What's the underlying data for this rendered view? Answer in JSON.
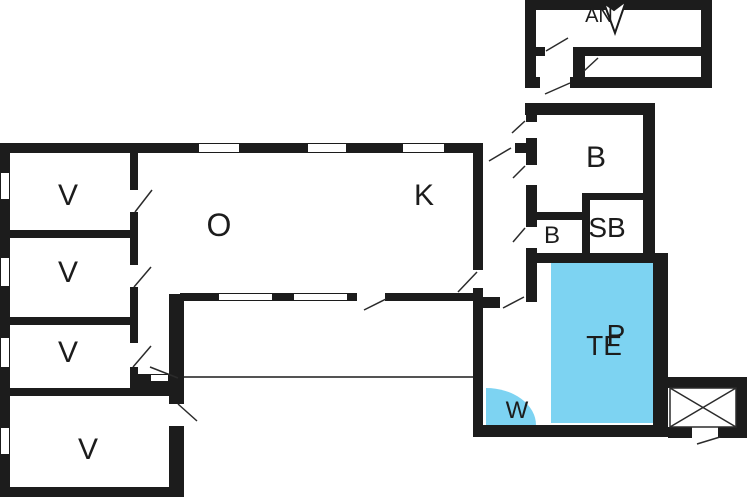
{
  "plan": {
    "type": "floor-plan",
    "background_color": "#ffffff",
    "wall_color": "#1c1c1c",
    "highlight_color": "#7dd3f2",
    "swing_line_color": "#2b2b2b"
  },
  "rooms": [
    {
      "id": "room-v-1",
      "label": "V"
    },
    {
      "id": "room-v-2",
      "label": "V"
    },
    {
      "id": "room-v-3",
      "label": "V"
    },
    {
      "id": "room-v-4",
      "label": "V"
    },
    {
      "id": "room-o",
      "label": "O"
    },
    {
      "id": "room-k",
      "label": "K"
    },
    {
      "id": "room-b-large",
      "label": "B"
    },
    {
      "id": "room-b-small",
      "label": "B"
    },
    {
      "id": "room-sb",
      "label": "SB"
    },
    {
      "id": "area-te",
      "label": "TE"
    },
    {
      "id": "area-p",
      "label": "P"
    },
    {
      "id": "area-w",
      "label": "W"
    },
    {
      "id": "annex",
      "label": "AN"
    }
  ]
}
